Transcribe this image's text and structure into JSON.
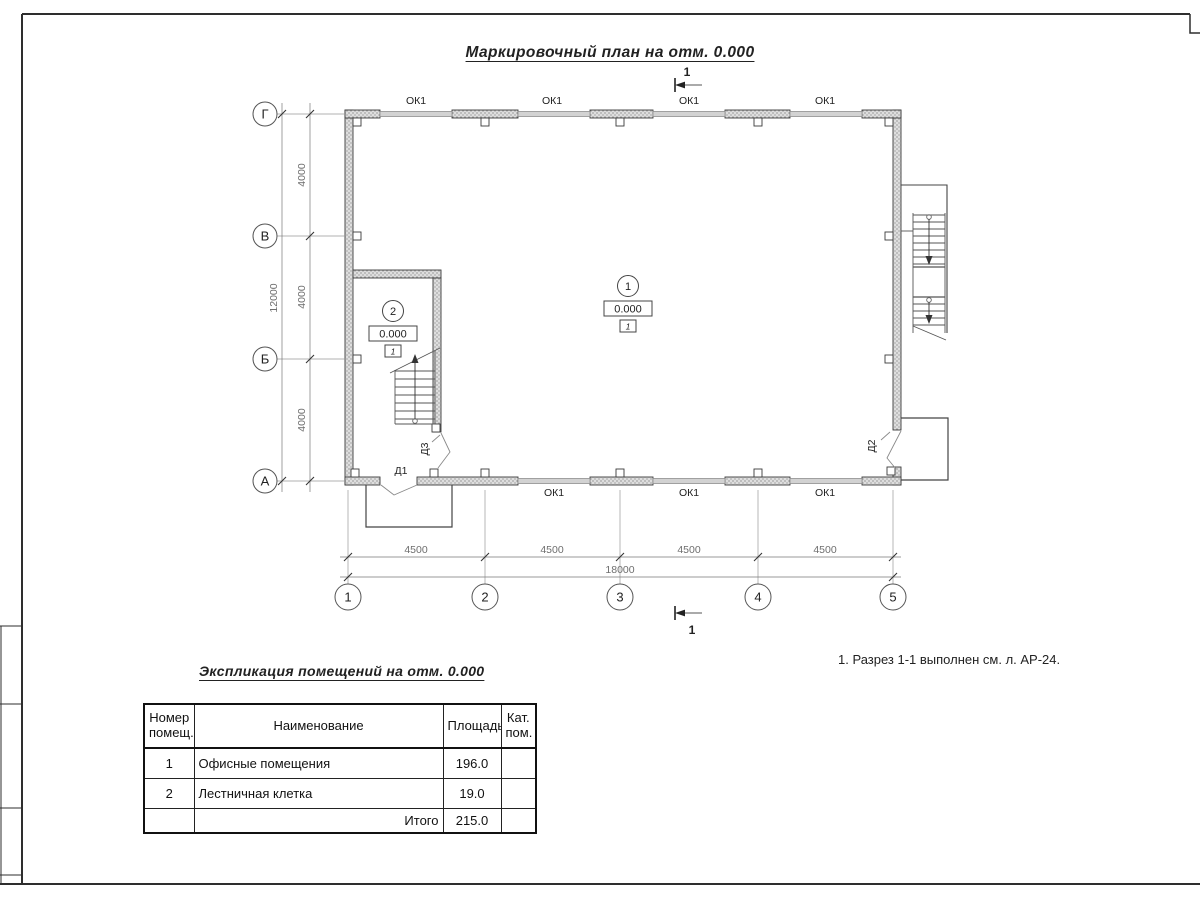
{
  "sheet": {
    "plan_title": "Маркировочный план на отм. 0.000",
    "note": "1. Разрез 1-1 выполнен см. л. АР-24."
  },
  "plan": {
    "axes_left": [
      "Г",
      "В",
      "Б",
      "А"
    ],
    "axes_bottom": [
      "1",
      "2",
      "3",
      "4",
      "5"
    ],
    "dims_left": [
      "4000",
      "4000",
      "4000"
    ],
    "dim_left_total": "12000",
    "dims_bottom": [
      "4500",
      "4500",
      "4500",
      "4500"
    ],
    "dim_bottom_total": "18000",
    "windows_top": [
      "ОК1",
      "ОК1",
      "ОК1",
      "ОК1"
    ],
    "windows_bottom": [
      "ОК1",
      "ОК1",
      "ОК1"
    ],
    "doors": {
      "d1": "Д1",
      "d2": "Д2",
      "d3": "Д3"
    },
    "section": {
      "top": "1",
      "bottom": "1"
    },
    "rooms": [
      {
        "number": "1",
        "elevation": "0.000",
        "floor_type": "1"
      },
      {
        "number": "2",
        "elevation": "0.000",
        "floor_type": "1"
      }
    ]
  },
  "schedule": {
    "title": "Экспликация помещений на отм. 0.000",
    "headers": {
      "number": "Номер\nпомещ.",
      "name": "Наименование",
      "area": "Площадь",
      "category": "Кат.\nпом."
    },
    "rows": [
      {
        "number": "1",
        "name": "Офисные помещения",
        "area": "196.0",
        "category": ""
      },
      {
        "number": "2",
        "name": "Лестничная клетка",
        "area": "19.0",
        "category": ""
      }
    ],
    "total_label": "Итого",
    "total_area": "215.0"
  },
  "colors": {
    "line": "#333333",
    "dim_line": "#808080",
    "wall_fill": "#d9d9d9",
    "paper": "#ffffff"
  }
}
